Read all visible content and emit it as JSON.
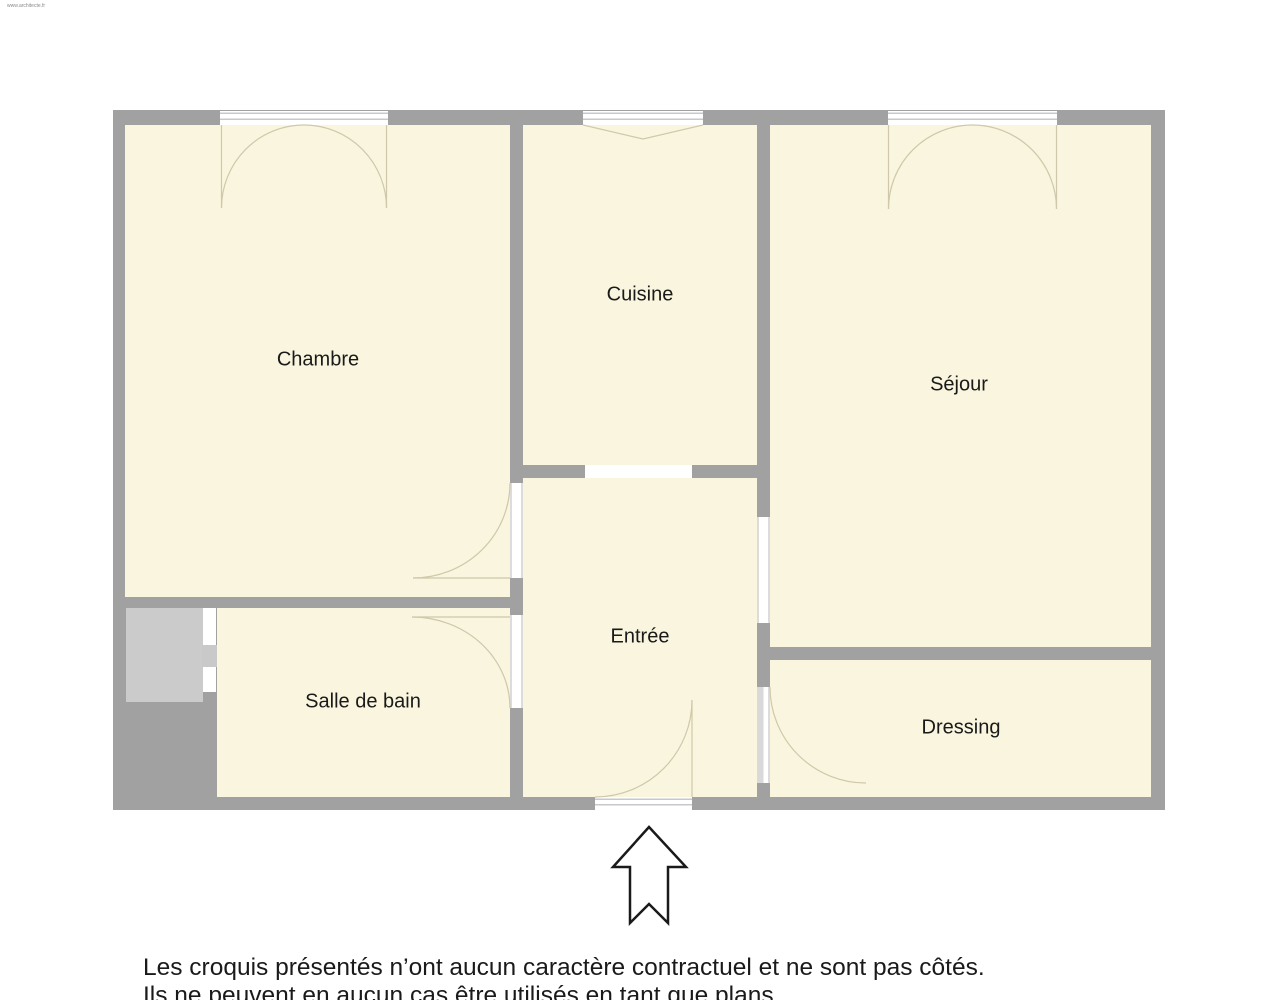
{
  "watermark": "www.architecte.fr",
  "rooms": [
    {
      "id": "chambre",
      "label": "Chambre"
    },
    {
      "id": "cuisine",
      "label": "Cuisine"
    },
    {
      "id": "sejour",
      "label": "Séjour"
    },
    {
      "id": "salle-de-bain",
      "label": "Salle de bain"
    },
    {
      "id": "entree",
      "label": "Entrée"
    },
    {
      "id": "dressing",
      "label": "Dressing"
    }
  ],
  "footer": {
    "line1": "Les croquis présentés n’ont aucun caractère contractuel et ne sont pas côtés.",
    "line2": "Ils ne peuvent en aucun cas être utilisés en tant que plans."
  },
  "colors": {
    "wall": "#a1a1a1",
    "room": "#f9f5de",
    "shaft": "#cbcbcb",
    "door-line": "#cfc8aa",
    "window-line": "#c6c8cb",
    "ink": "#1a1a1a",
    "bg": "#ffffff"
  }
}
